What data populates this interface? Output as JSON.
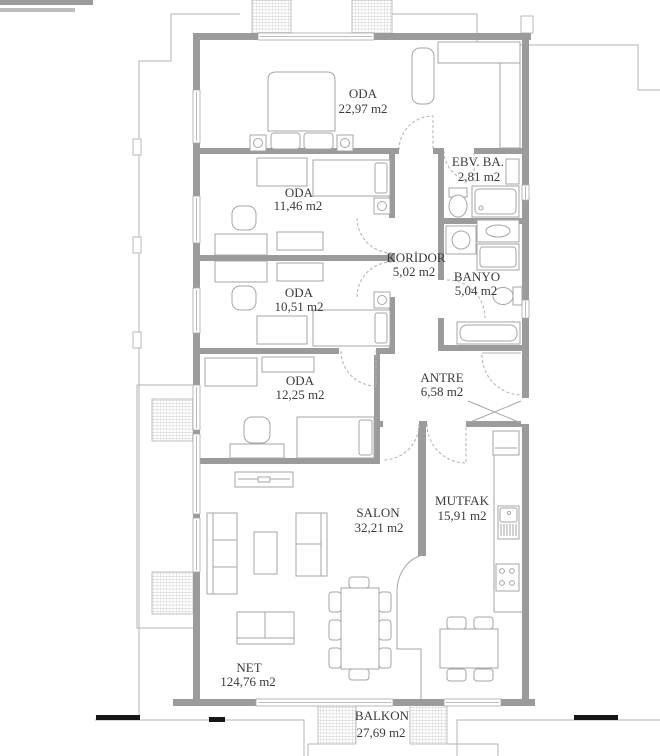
{
  "rooms": [
    {
      "id": "oda-ebeveyn",
      "name": "ODA",
      "area": "22,97 m2"
    },
    {
      "id": "oda-2",
      "name": "ODA",
      "area": "11,46 m2"
    },
    {
      "id": "oda-3",
      "name": "ODA",
      "area": "10,51 m2"
    },
    {
      "id": "koridor",
      "name": "KORİDOR",
      "area": "5,02 m2"
    },
    {
      "id": "ebeveyn-banyo",
      "name": "EBV. BA.",
      "area": "2,81 m2"
    },
    {
      "id": "banyo",
      "name": "BANYO",
      "area": "5,04 m2"
    },
    {
      "id": "oda-4",
      "name": "ODA",
      "area": "12,25 m2"
    },
    {
      "id": "antre",
      "name": "ANTRE",
      "area": "6,58 m2"
    },
    {
      "id": "salon",
      "name": "SALON",
      "area": "32,21 m2"
    },
    {
      "id": "mutfak",
      "name": "MUTFAK",
      "area": "15,91 m2"
    },
    {
      "id": "net",
      "name": "NET",
      "area": "124,76 m2"
    },
    {
      "id": "balkon",
      "name": "BALKON",
      "area": "27,69 m2"
    }
  ],
  "colors": {
    "wall": "#9b9b9b",
    "furniture_line": "#a6a6a6",
    "outline": "#b3b3b3",
    "text": "#3b3b3b",
    "background": "#ffffff"
  }
}
